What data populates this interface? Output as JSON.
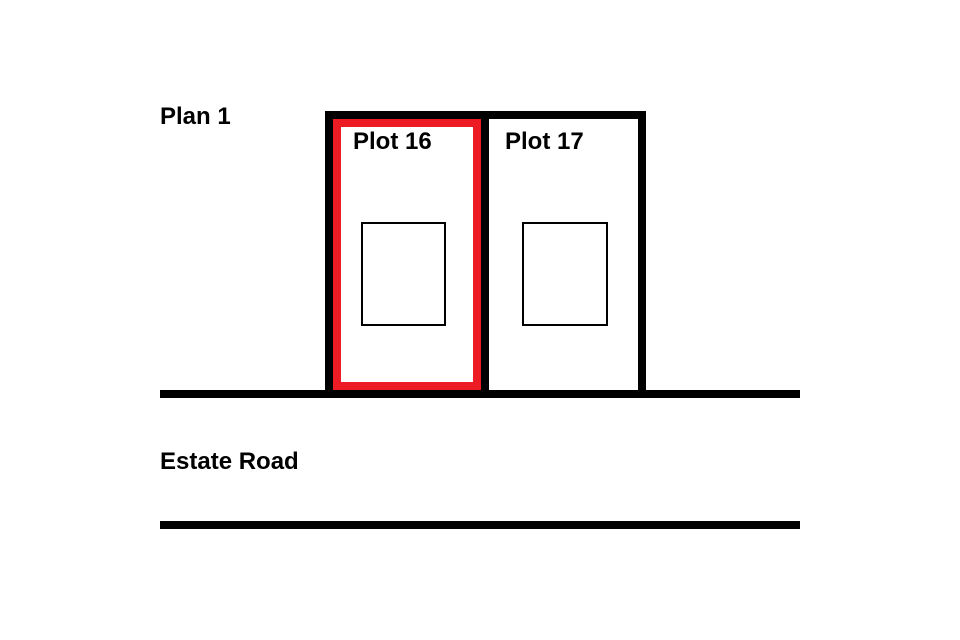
{
  "plan": {
    "title": "Plan 1",
    "road": {
      "label": "Estate Road"
    },
    "plots": [
      {
        "id": "plot-16",
        "label": "Plot 16",
        "highlighted": true
      },
      {
        "id": "plot-17",
        "label": "Plot 17",
        "highlighted": false
      }
    ]
  },
  "colors": {
    "background": "#ffffff",
    "outline": "#000000",
    "text": "#000000",
    "highlight": "#ed1c24"
  }
}
